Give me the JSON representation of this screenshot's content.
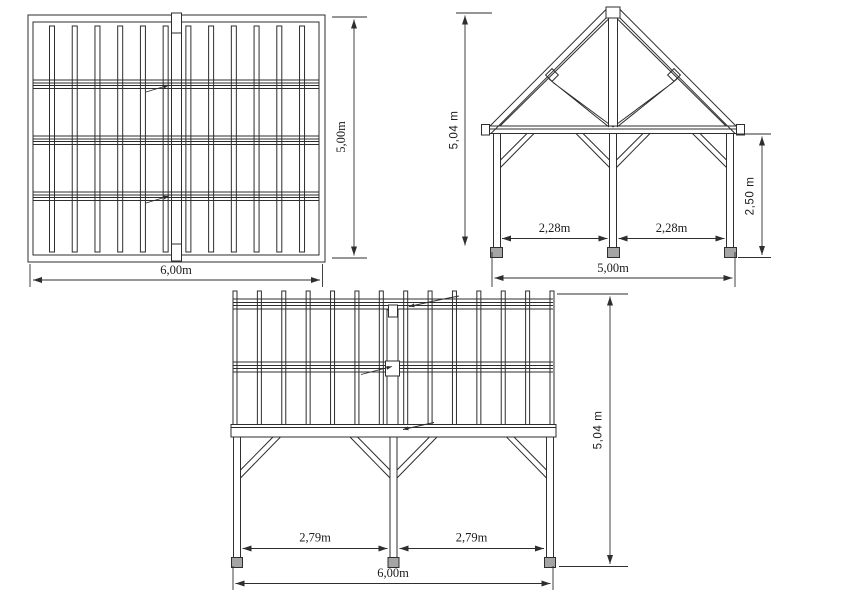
{
  "drawing": {
    "colors": {
      "line": "#2e2e2e",
      "footing": "#a5a5a5",
      "background": "#ffffff"
    },
    "views": {
      "plan": {
        "rafter_count": 12,
        "dim_width": "6,00m",
        "dim_depth": "5,00m"
      },
      "gable": {
        "dim_total_height": "5,04 m",
        "dim_post_height": "2,50 m",
        "dim_bay_left": "2,28m",
        "dim_bay_right": "2,28m",
        "dim_width": "5,00m"
      },
      "side": {
        "rafter_count": 14,
        "dim_total_height": "5,04 m",
        "dim_bay_left": "2,79m",
        "dim_bay_right": "2,79m",
        "dim_width": "6,00m"
      }
    }
  }
}
